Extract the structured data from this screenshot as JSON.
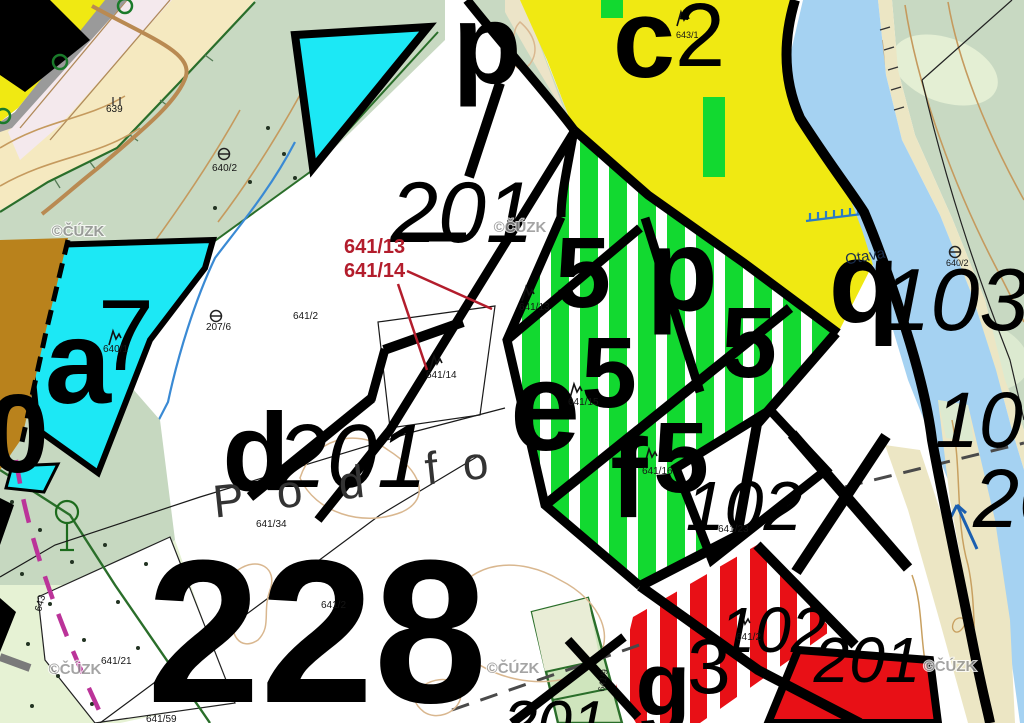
{
  "attribution": "©ČÚZK",
  "palette": {
    "yellow": "#f0e912",
    "cyan": "#1ce8f5",
    "stripe_green": "#12d930",
    "red": "#e81016",
    "ochre": "#b9821c",
    "beige": "#f5e9c0",
    "sage": "#c8d9c2",
    "sage_light": "#e4efd4",
    "orchard": "#e6f2d4",
    "river_blue": "#a5d2f2",
    "river_edge": "#2277cc",
    "sand": "#ece6c4",
    "contour": "#c59a5e",
    "magenta": "#bb3399",
    "dark_green": "#2a6e2a",
    "red_annotation": "#b31d2c",
    "watermark_gray": "#8e8e8e"
  },
  "river": {
    "name": "Otava",
    "x": 866,
    "y": 261,
    "rot": -10,
    "fill": "#1b2f4e",
    "size": 15
  },
  "place_name": {
    "text": "Pod fo",
    "letters": [
      {
        "ch": "P",
        "x": 230,
        "y": 516
      },
      {
        "ch": "o",
        "x": 291,
        "y": 507
      },
      {
        "ch": "d",
        "x": 353,
        "y": 498
      },
      {
        "ch": "f",
        "x": 433,
        "y": 484
      },
      {
        "ch": "o",
        "x": 477,
        "y": 479
      }
    ],
    "size": 46,
    "fill": "#333333",
    "rot": -6
  },
  "red_annotations": {
    "items": [
      {
        "text": "641/13",
        "x": 344,
        "y": 253
      },
      {
        "text": "641/14",
        "x": 344,
        "y": 277
      }
    ],
    "leaders": [
      [
        407,
        271,
        492,
        309
      ],
      [
        398,
        284,
        427,
        370
      ]
    ],
    "size": 20
  },
  "parcel_201_underbar": [
    398,
    237,
    466,
    237
  ],
  "large_labels": [
    {
      "text": "p",
      "x": 487,
      "y": 83,
      "size": 113,
      "bold": true
    },
    {
      "text": "201",
      "x": 462,
      "y": 242,
      "size": 86,
      "italic": true
    },
    {
      "text": "c",
      "x": 644,
      "y": 77,
      "size": 112,
      "bold": true
    },
    {
      "text": "2",
      "x": 700,
      "y": 66,
      "size": 90
    },
    {
      "text": "a",
      "x": 78,
      "y": 403,
      "size": 119,
      "bold": true
    },
    {
      "text": "7",
      "x": 126,
      "y": 370,
      "size": 101
    },
    {
      "text": "0",
      "x": 18,
      "y": 472,
      "size": 111,
      "bold": true
    },
    {
      "text": "d",
      "x": 256,
      "y": 490,
      "size": 110,
      "bold": true
    },
    {
      "text": "201",
      "x": 352,
      "y": 487,
      "size": 90,
      "italic": true
    },
    {
      "text": "228",
      "x": 317,
      "y": 702,
      "size": 204,
      "bold": true
    },
    {
      "text": "5",
      "x": 583,
      "y": 307,
      "size": 100,
      "bold": true
    },
    {
      "text": "p",
      "x": 682,
      "y": 310,
      "size": 117,
      "bold": true
    },
    {
      "text": "5",
      "x": 749,
      "y": 377,
      "size": 100,
      "bold": true
    },
    {
      "text": "e",
      "x": 545,
      "y": 450,
      "size": 126,
      "bold": true
    },
    {
      "text": "5",
      "x": 609,
      "y": 407,
      "size": 100,
      "bold": true
    },
    {
      "text": "f",
      "x": 629,
      "y": 517,
      "size": 112,
      "bold": true
    },
    {
      "text": "5",
      "x": 681,
      "y": 492,
      "size": 100,
      "bold": true
    },
    {
      "text": "102",
      "x": 744,
      "y": 530,
      "size": 70,
      "italic": true
    },
    {
      "text": "q",
      "x": 864,
      "y": 322,
      "size": 116,
      "bold": true
    },
    {
      "text": "103",
      "x": 955,
      "y": 330,
      "size": 88,
      "italic": true
    },
    {
      "text": "103",
      "x": 935,
      "y": 447,
      "size": 79,
      "italic": true,
      "anchor": "start"
    },
    {
      "text": "201",
      "x": 973,
      "y": 527,
      "size": 83,
      "italic": true,
      "anchor": "start"
    },
    {
      "text": "g",
      "x": 663,
      "y": 715,
      "size": 90,
      "bold": true
    },
    {
      "text": "3",
      "x": 709,
      "y": 693,
      "size": 78
    },
    {
      "text": "102",
      "x": 773,
      "y": 652,
      "size": 64,
      "italic": true
    },
    {
      "text": "201",
      "x": 867,
      "y": 682,
      "size": 64,
      "italic": true
    },
    {
      "text": "201",
      "x": 503,
      "y": 744,
      "size": 62,
      "italic": true,
      "anchor": "start"
    }
  ],
  "small_labels": [
    {
      "text": "639",
      "x": 106,
      "y": 112
    },
    {
      "text": "640/2",
      "x": 212,
      "y": 171
    },
    {
      "text": "643/1",
      "x": 676,
      "y": 38,
      "size": 9
    },
    {
      "text": "207/6",
      "x": 206,
      "y": 330
    },
    {
      "text": "640/1",
      "x": 103,
      "y": 352
    },
    {
      "text": "641/2",
      "x": 293,
      "y": 319
    },
    {
      "text": "641/13",
      "x": 519,
      "y": 310
    },
    {
      "text": "641/14",
      "x": 426,
      "y": 378
    },
    {
      "text": "641/15",
      "x": 568,
      "y": 405
    },
    {
      "text": "641/16",
      "x": 642,
      "y": 474
    },
    {
      "text": "641/23",
      "x": 718,
      "y": 532
    },
    {
      "text": "641/34",
      "x": 256,
      "y": 527
    },
    {
      "text": "641/21",
      "x": 101,
      "y": 664
    },
    {
      "text": "641/2",
      "x": 321,
      "y": 608
    },
    {
      "text": "641/2",
      "x": 736,
      "y": 640
    },
    {
      "text": "641/59",
      "x": 146,
      "y": 722
    },
    {
      "text": "640/2",
      "x": 946,
      "y": 266,
      "size": 9
    }
  ],
  "rotated_labels": [
    {
      "text": "643",
      "x": 41,
      "y": 612,
      "rot": -75,
      "size": 10
    },
    {
      "text": "641/9",
      "x": 604,
      "y": 692,
      "rot": -80,
      "size": 9
    }
  ],
  "watermarks": [
    {
      "x": 78,
      "y": 236
    },
    {
      "x": 520,
      "y": 232
    },
    {
      "x": 75,
      "y": 674
    },
    {
      "x": 513,
      "y": 673
    },
    {
      "x": 950,
      "y": 671
    }
  ],
  "symbols": {
    "trees": [
      [
        683,
        17
      ],
      [
        115,
        336
      ],
      [
        528,
        292
      ],
      [
        436,
        361
      ],
      [
        576,
        389
      ],
      [
        651,
        454
      ],
      [
        744,
        621
      ]
    ],
    "rings": [
      [
        125,
        6
      ],
      [
        60,
        62
      ],
      [
        3,
        116
      ]
    ],
    "boundary_markers": [
      [
        224,
        154
      ],
      [
        216,
        316
      ],
      [
        955,
        252
      ]
    ],
    "meadow_marks": [
      [
        116,
        97
      ]
    ]
  }
}
